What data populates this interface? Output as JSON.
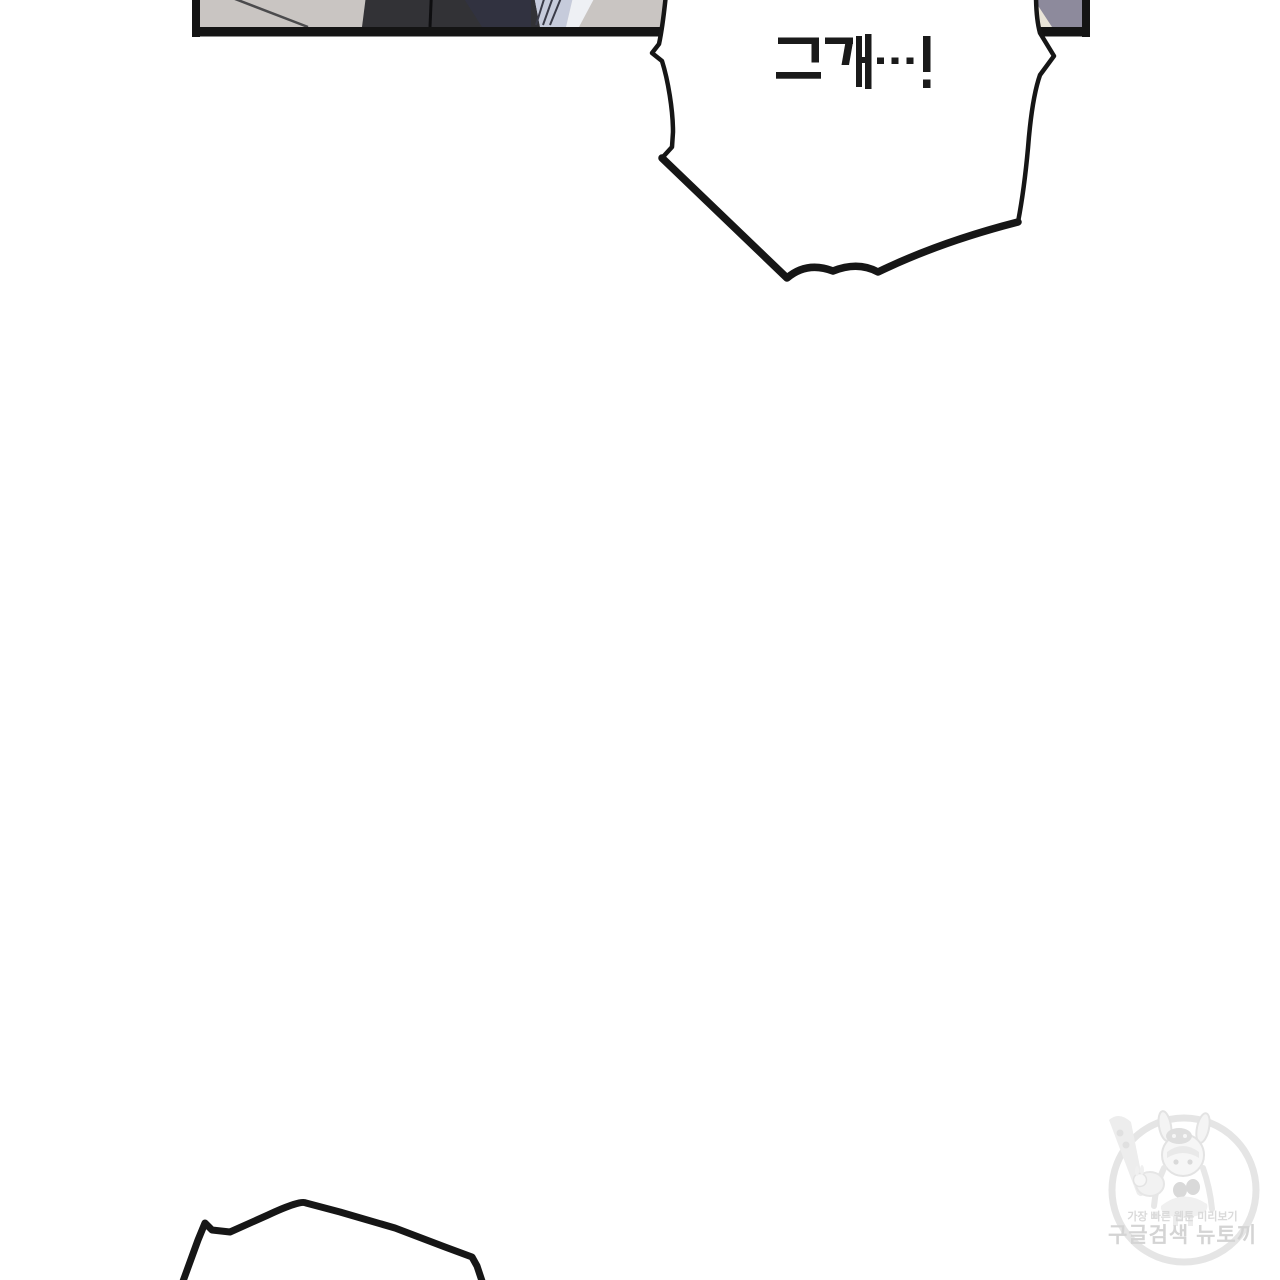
{
  "page": {
    "background_color": "#ffffff",
    "width": 1280,
    "height": 1280
  },
  "comic_panel": {
    "border_color": "#141414",
    "wall_color": "#c9c5c2",
    "wall_line_color": "#4b4b4d",
    "clothing_dark_color": "#323236",
    "clothing_navy_color": "#313240",
    "fabric_light_color": "#c6cbdb",
    "fabric_highlight_color": "#eef0f4",
    "fabric_fold_color": "#3a3b48",
    "garment_purple_color": "#8d8a9c",
    "skin_sliver_color": "#e9e4d8"
  },
  "speech_bubble": {
    "text": "그게…!",
    "fill_color": "#ffffff",
    "outline_color": "#161616",
    "text_color": "#1a1a1a"
  },
  "bottom_bubble": {
    "fill_color": "#ffffff",
    "outline_color": "#161616"
  },
  "watermark": {
    "line1": "가장 빠른 웹툰 미리보기",
    "line2": "구글검색 뉴토끼",
    "text_color": "#d5d5d5",
    "art_color": "#e7e7e7",
    "mascot": "rabbit-hood-girl-with-carrot-logo"
  }
}
